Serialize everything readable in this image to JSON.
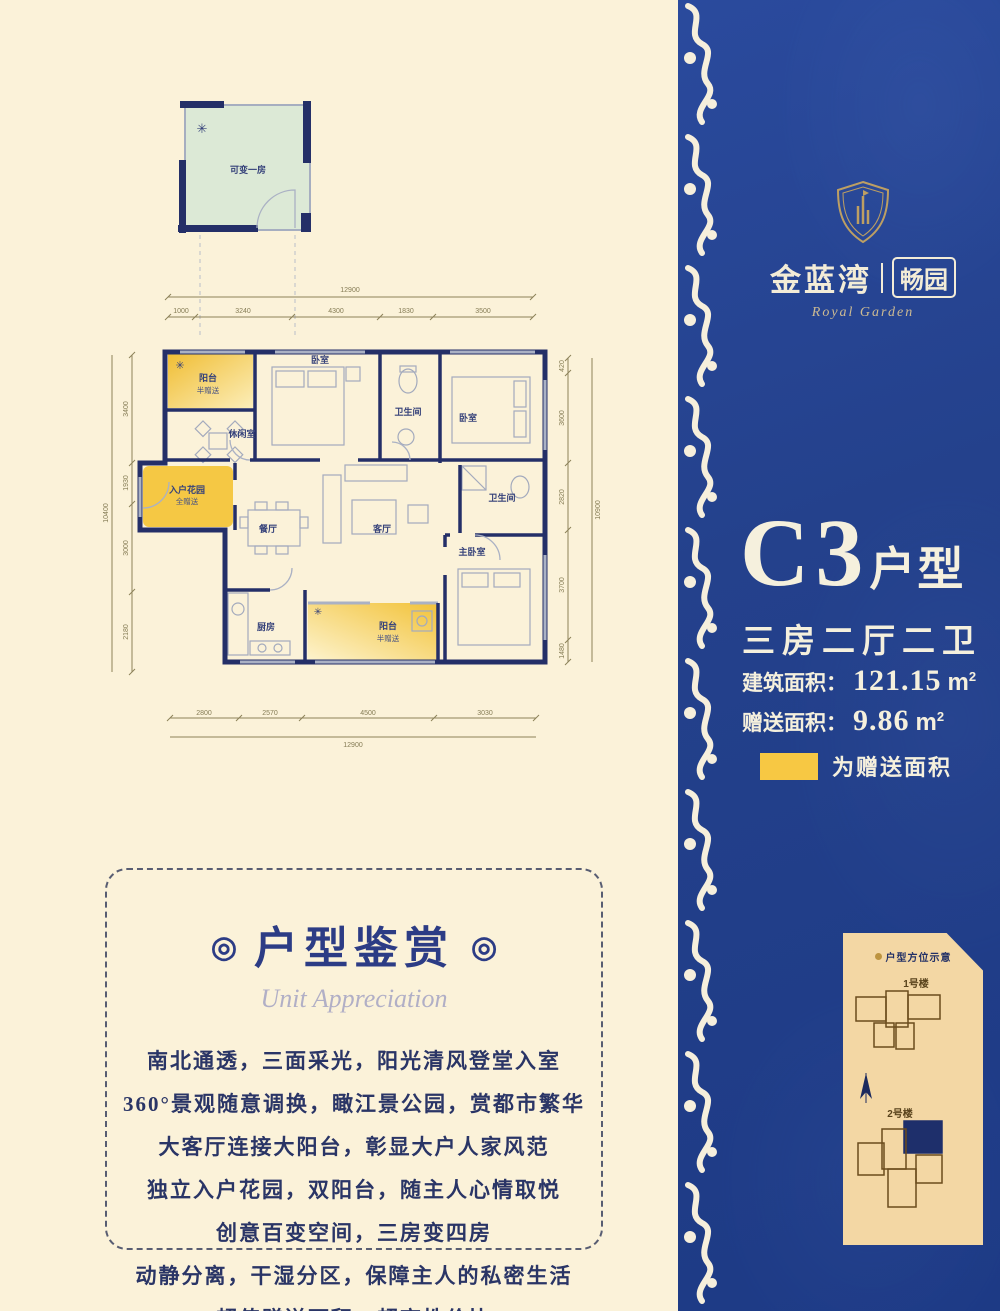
{
  "brand": {
    "name_left": "金蓝湾",
    "name_right": "畅园",
    "tagline": "Royal Garden"
  },
  "unit": {
    "code": "C3",
    "code_suffix": "户型",
    "layout": "三房二厅二卫",
    "area_label": "建筑面积：",
    "area_value": "121.15",
    "gift_label": "赠送面积：",
    "gift_value": "9.86",
    "area_unit_base": "m",
    "area_unit_sup": "2",
    "legend_label": "为赠送面积"
  },
  "site_card": {
    "title": "户型方位示意",
    "building1": "1号楼",
    "building2": "2号楼"
  },
  "appreciation": {
    "title": "户型鉴赏",
    "ring": "◎",
    "subtitle": "Unit Appreciation",
    "lines": [
      "南北通透，三面采光，阳光清风登堂入室",
      "360°景观随意调换，瞰江景公园，赏都市繁华",
      "大客厅连接大阳台，彰显大户人家风范",
      "独立入户花园，双阳台，随主人心情取悦",
      "创意百变空间，三房变四房",
      "动静分离，干湿分区，保障主人的私密生活",
      "超值赠送面积，超高性价比"
    ]
  },
  "plan": {
    "detached_room_label": "可变一房",
    "ac_icon": "✳",
    "rooms": {
      "balcony_top": {
        "label": "阳台",
        "sub": "半赠送"
      },
      "bedroom_1": {
        "label": "卧室"
      },
      "bath_1": {
        "label": "卫生间"
      },
      "bedroom_2": {
        "label": "卧室"
      },
      "leisure": {
        "label": "休闲室"
      },
      "entry_garden": {
        "label": "入户花园",
        "sub": "全赠送"
      },
      "dining": {
        "label": "餐厅"
      },
      "living": {
        "label": "客厅"
      },
      "kitchen": {
        "label": "厨房"
      },
      "balcony_bottom": {
        "label": "阳台",
        "sub": "半赠送"
      },
      "bath_2": {
        "label": "卫生间"
      },
      "master": {
        "label": "主卧室"
      }
    },
    "dims": {
      "top_total": "12900",
      "top": [
        "1000",
        "3240",
        "4300",
        "1830",
        "3500"
      ],
      "bottom": [
        "2800",
        "2570",
        "4500",
        "3030"
      ],
      "bottom_total": "12900",
      "left": [
        "3400",
        "1930",
        "3000",
        "2180"
      ],
      "left_total": "10400",
      "right": [
        "420",
        "3600",
        "2820",
        "3700",
        "1480"
      ],
      "right_total": "10900"
    }
  },
  "colors": {
    "panel_blue": "#24418c",
    "accent_gold": "#f7c843",
    "wall_navy": "#242f68",
    "card_tan": "#f3d7a4",
    "highlight_navy": "#1e2f6b",
    "page_cream": "#fbf2d9"
  }
}
